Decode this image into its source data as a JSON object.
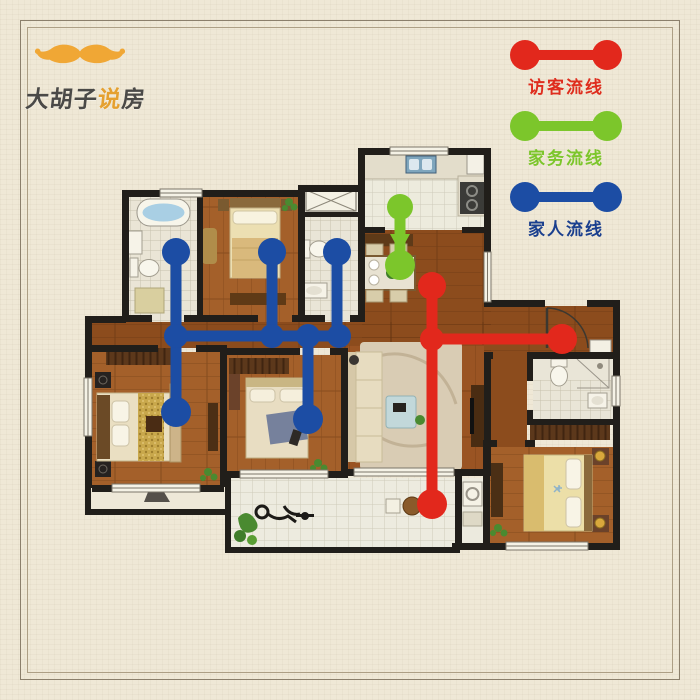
{
  "logo": {
    "brand_prefix": "大胡子",
    "brand_highlight": "说",
    "brand_suffix": "房",
    "mustache_color": "#f0a735"
  },
  "legend": {
    "items": [
      {
        "id": "visitor",
        "label": "访客流线",
        "color": "#e2281c",
        "text_color": "#df2d1e"
      },
      {
        "id": "housework",
        "label": "家务流线",
        "color": "#7cc62b",
        "text_color": "#7cc62b"
      },
      {
        "id": "family",
        "label": "家人流线",
        "color": "#1c4da4",
        "text_color": "#1a3f8e"
      }
    ]
  },
  "floorplan": {
    "flows": [
      {
        "id": "family-flow",
        "label": "家人流线",
        "color": "#1c4da4",
        "stroke": 11,
        "segments": [
          [
            176,
            336,
            343,
            336
          ],
          [
            176,
            252,
            176,
            412
          ],
          [
            272,
            252,
            272,
            336
          ],
          [
            337,
            252,
            337,
            336
          ],
          [
            308,
            336,
            308,
            419
          ]
        ],
        "junctions": [
          {
            "x": 176,
            "y": 336,
            "r": 12
          },
          {
            "x": 272,
            "y": 336,
            "r": 12
          },
          {
            "x": 308,
            "y": 336,
            "r": 12
          },
          {
            "x": 339,
            "y": 336,
            "r": 12
          }
        ],
        "nodes": [
          {
            "x": 176,
            "y": 252,
            "r": 14
          },
          {
            "x": 272,
            "y": 252,
            "r": 14
          },
          {
            "x": 337,
            "y": 252,
            "r": 14
          },
          {
            "x": 176,
            "y": 412,
            "r": 15
          },
          {
            "x": 308,
            "y": 419,
            "r": 15
          }
        ]
      },
      {
        "id": "housework-flow",
        "label": "家务流线",
        "color": "#7cc62b",
        "stroke": 11,
        "segments": [
          [
            400,
            207,
            400,
            263
          ]
        ],
        "junctions": [],
        "nodes": [
          {
            "x": 400,
            "y": 207,
            "r": 13
          },
          {
            "x": 400,
            "y": 265,
            "r": 15
          }
        ],
        "arrow": {
          "x": 400,
          "y": 252,
          "w": 20,
          "h": 18
        }
      },
      {
        "id": "visitor-flow",
        "label": "访客流线",
        "color": "#e2281c",
        "stroke": 11,
        "segments": [
          [
            432,
            339,
            562,
            339
          ],
          [
            432,
            286,
            432,
            339
          ],
          [
            432,
            339,
            432,
            504
          ]
        ],
        "junctions": [
          {
            "x": 432,
            "y": 339,
            "r": 12
          }
        ],
        "nodes": [
          {
            "x": 562,
            "y": 339,
            "r": 15
          },
          {
            "x": 432,
            "y": 286,
            "r": 14
          },
          {
            "x": 432,
            "y": 504,
            "r": 15
          }
        ]
      }
    ]
  }
}
